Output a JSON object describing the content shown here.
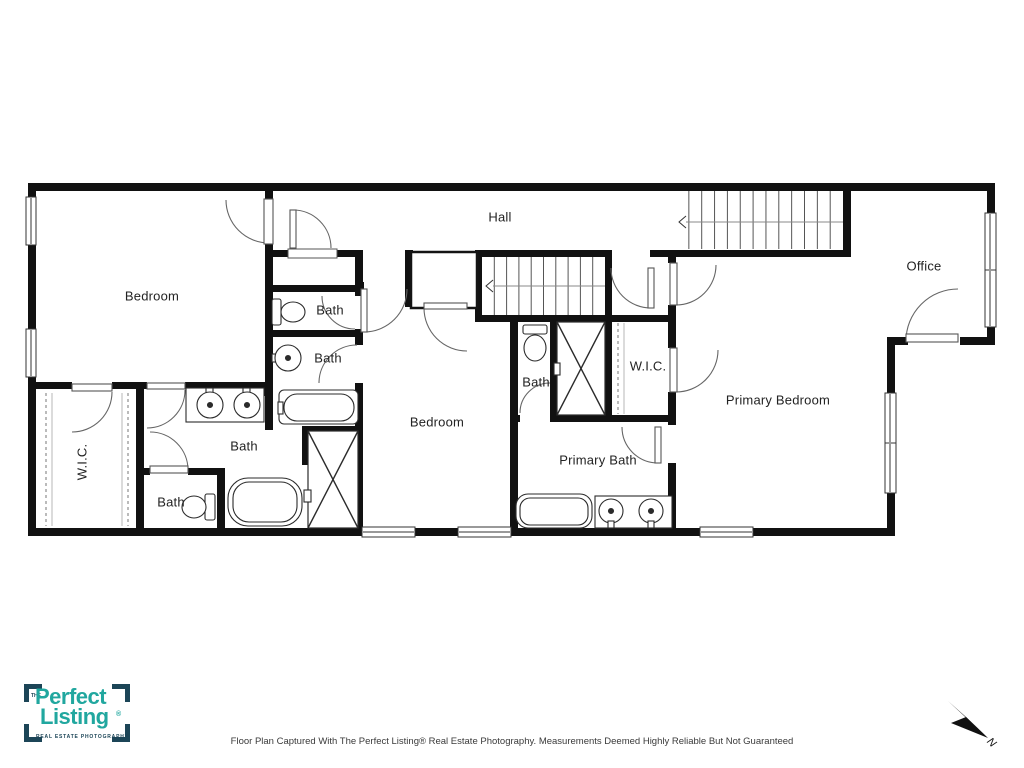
{
  "floor_plan": {
    "labels": {
      "hall": "Hall",
      "office": "Office",
      "bedroom_upper": "Bedroom",
      "bedroom_middle": "Bedroom",
      "primary_bedroom": "Primary Bedroom",
      "primary_bath": "Primary Bath",
      "wic_left": "W.I.C.",
      "wic_middle": "W.I.C.",
      "baths": [
        "Bath",
        "Bath",
        "Bath",
        "Bath",
        "Bath"
      ]
    },
    "compass_north": "N"
  },
  "branding": {
    "logo_the": "THE",
    "logo_word1": "Perfect",
    "logo_word2": "Listing",
    "logo_registered": "®",
    "logo_tagline": "REAL ESTATE PHOTOGRAPHY",
    "teal": "#21a79f",
    "navy": "#1c4557"
  },
  "caption": "Floor Plan Captured With The Perfect Listing® Real Estate Photography. Measurements Deemed Highly Reliable But Not Guaranteed"
}
